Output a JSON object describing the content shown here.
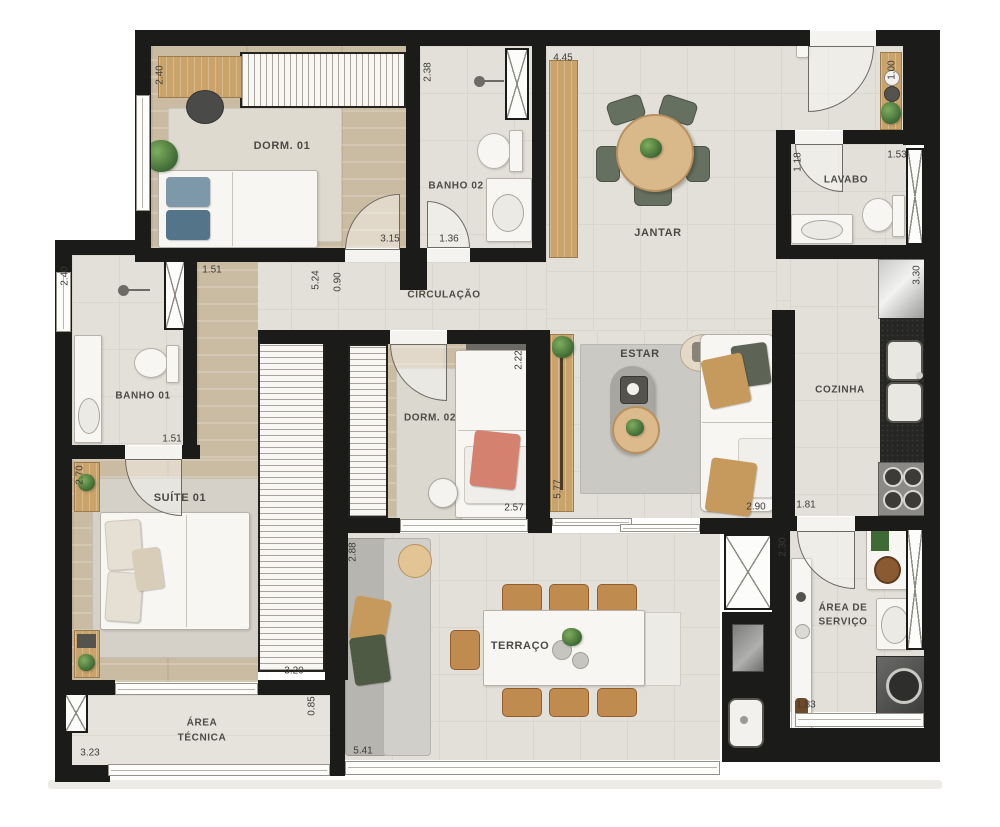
{
  "plan": {
    "title": "apartment-floor-plan",
    "rooms": {
      "dorm1": "DORM. 01",
      "banho2": "BANHO 02",
      "jantar": "JANTAR",
      "lavabo": "LAVABO",
      "circulacao": "CIRCULAÇÃO",
      "banho1": "BANHO 01",
      "cozinha": "COZINHA",
      "estar": "ESTAR",
      "dorm2": "DORM. 02",
      "suite1": "SUÍTE 01",
      "terraco": "TERRAÇO",
      "servico_line1": "ÁREA DE",
      "servico_line2": "SERVIÇO",
      "tecnica_line1": "ÁREA",
      "tecnica_line2": "TÉCNICA"
    },
    "dims": {
      "dorm1_h": "2.40",
      "dorm1_w": "3.15",
      "banho2_h": "2.38",
      "banho2_w": "1.36",
      "jantar_w": "4.45",
      "shelf_h": "1.00",
      "lavabo_h": "1.18",
      "lavabo_w": "1.53",
      "circ_h": "0.90",
      "hall_w": "1.51",
      "hall_h": "5.24",
      "banho1_h": "2.40",
      "banho1_w": "1.51",
      "dorm2_h": "2.22",
      "dorm2_w": "2.57",
      "estar_h": "5.77",
      "estar_w": "2.90",
      "cozinha_h": "3.30",
      "cozinha_w": "1.81",
      "suite_h": "2.70",
      "suite_w": "3.20",
      "terraco_h": "2.88",
      "terraco_w": "5.41",
      "servico_h": "2.30",
      "servico_w": "1.83",
      "tecnica_w": "3.23",
      "tecnica_h": "0.85"
    },
    "colors": {
      "wall": "#1b1b1a",
      "tile_floor": "#e3e0d9",
      "wood_floor": "#cabba3",
      "furniture_wood": "#c9a36a",
      "chair_green": "#667060",
      "chair_tan": "#c08b4e",
      "pillow_blue": "#7d98a8",
      "pillow_salmon": "#d4826f"
    }
  }
}
